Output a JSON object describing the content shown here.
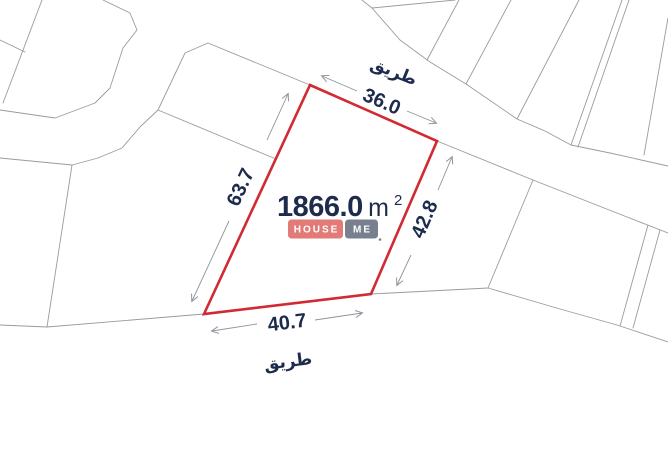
{
  "plot": {
    "area_value": "1866.0",
    "area_unit": "m",
    "area_superscript": "2",
    "edges": {
      "top": "36.0",
      "right": "42.8",
      "bottom": "40.7",
      "left": "63.7"
    }
  },
  "roads": {
    "top": "طريق",
    "bottom": "طريق"
  },
  "badge": {
    "left_text": "HOUSE",
    "right_text": "ME",
    "left_bg": "#e27b78",
    "right_bg": "#78808f",
    "text_color": "#ffffff"
  },
  "colors": {
    "background": "#ffffff",
    "plot_outline": "#d12a33",
    "plot_fill": "#ffffff",
    "parcel_line": "#9b9b9b",
    "dimension_line": "#8f949d",
    "label_text": "#1d2b4d"
  }
}
